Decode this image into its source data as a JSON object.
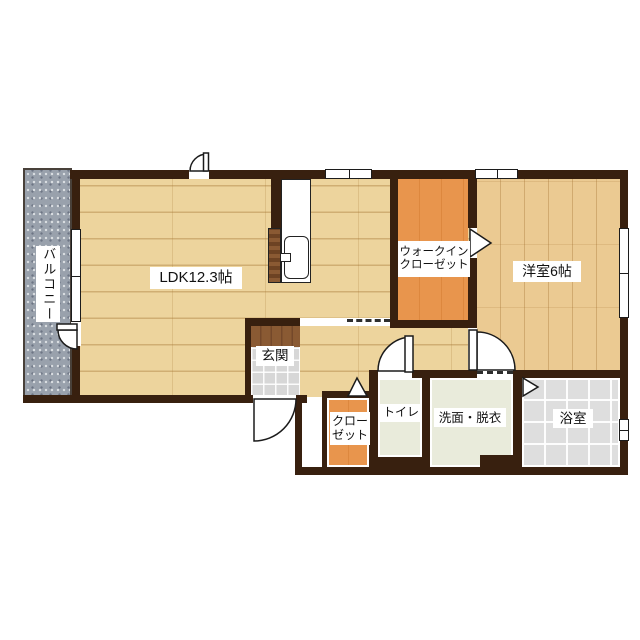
{
  "floorplan": {
    "type": "japanese-apartment-floor-plan",
    "rooms": {
      "balcony": {
        "label": "バルコニー"
      },
      "ldk": {
        "label": "LDK12.3帖"
      },
      "walk_in_closet": {
        "label_line1": "ウォークイン",
        "label_line2": "クローゼット"
      },
      "western_room": {
        "label": "洋室6帖"
      },
      "entrance": {
        "label": "玄関"
      },
      "closet": {
        "label_line1": "クロー",
        "label_line2": "ゼット"
      },
      "toilet": {
        "label": "トイレ"
      },
      "washroom": {
        "label": "洗面・脱衣"
      },
      "bathroom": {
        "label": "浴室"
      }
    },
    "colors": {
      "wall": "#38200f",
      "ldk_floor": "#edd49d",
      "western_room_floor": "#ebca92",
      "closet_orange": "#e8954d",
      "entrance_mat_brown": "#8a5a33",
      "entrance_tile_gray": "#d7d7d7",
      "service_room_green": "#e9ebdb",
      "bathroom_tile_gray": "#dedede",
      "balcony_gray": "#99a1ac",
      "background": "#ffffff"
    },
    "features": {
      "swing_door_count": 5,
      "folding_door_marker_count": 3,
      "window_count": 5
    }
  }
}
